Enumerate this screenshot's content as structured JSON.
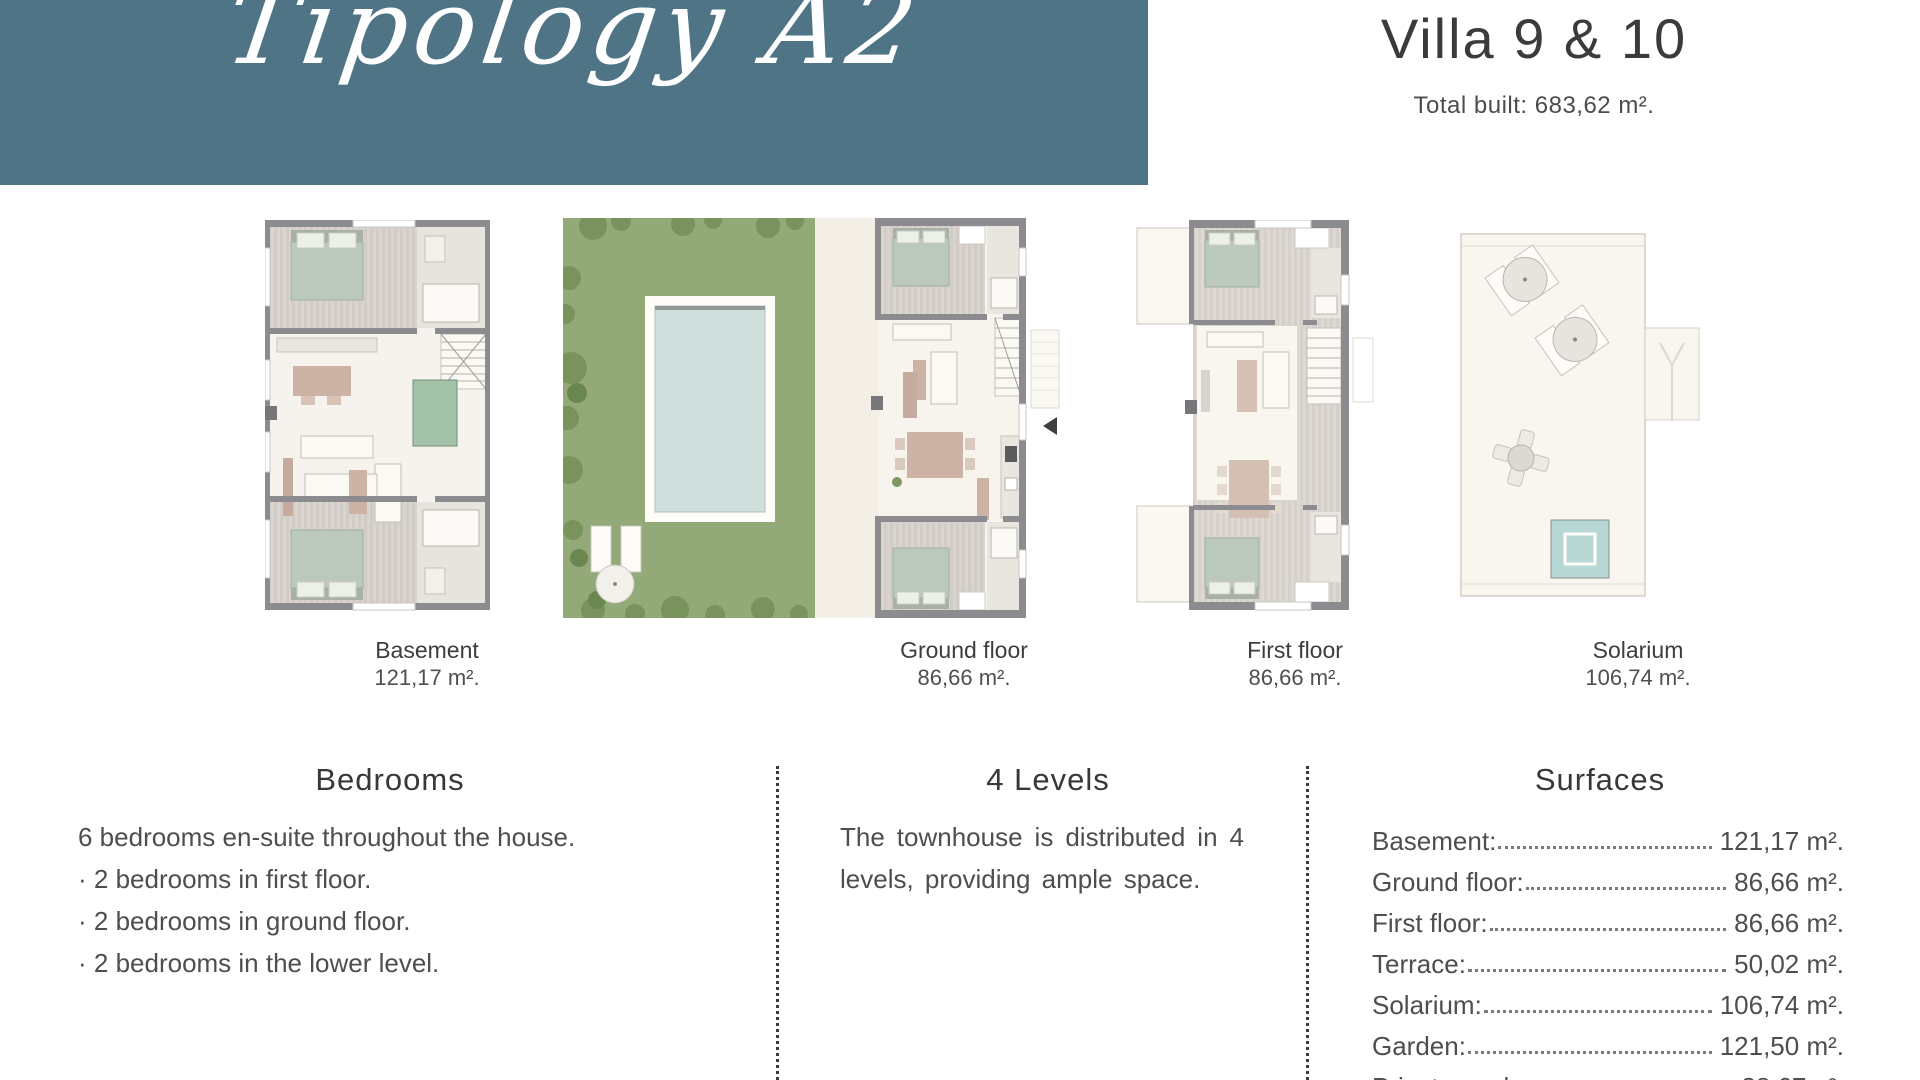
{
  "header": {
    "script_title": "Tipology A2",
    "villa_title": "Villa 9 & 10",
    "total_built": "Total built: 683,62 m².",
    "band_color": "#4e7486"
  },
  "plans": [
    {
      "name": "Basement",
      "area": "121,17 m²."
    },
    {
      "name": "Ground floor",
      "area": "86,66 m²."
    },
    {
      "name": "First floor",
      "area": "86,66 m²."
    },
    {
      "name": "Solarium",
      "area": "106,74 m²."
    }
  ],
  "sections": {
    "bedrooms": {
      "title": "Bedrooms",
      "lines": [
        "6 bedrooms en-suite throughout the house.",
        "· 2 bedrooms in first floor.",
        "· 2 bedrooms in  ground floor.",
        "· 2 bedrooms in the lower level."
      ]
    },
    "levels": {
      "title": "4 Levels",
      "body": "The townhouse is distributed in 4 levels, providing ample space."
    },
    "surfaces": {
      "title": "Surfaces",
      "rows": [
        {
          "label": "Basement:",
          "value": "121,17 m²."
        },
        {
          "label": "Ground floor:",
          "value": "86,66 m²."
        },
        {
          "label": "First floor:",
          "value": "86,66 m²."
        },
        {
          "label": "Terrace:",
          "value": "50,02 m²."
        },
        {
          "label": "Solarium:",
          "value": "106,74 m²."
        },
        {
          "label": "Garden:",
          "value": "121,50 m²."
        },
        {
          "label": "Private pool:",
          "value": "38,67m²."
        }
      ]
    }
  }
}
